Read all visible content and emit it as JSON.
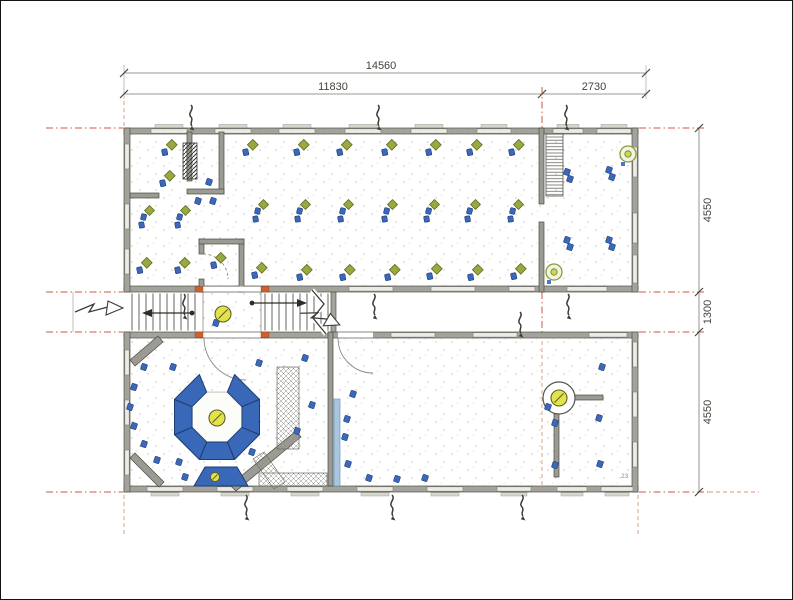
{
  "dimensions": {
    "total_width": "14560",
    "left_width": "11830",
    "right_width": "2730",
    "upper_depth": "4550",
    "corridor_depth": "1300",
    "lower_depth": "4550"
  },
  "annotations": {
    "room_number": "23"
  },
  "colors": {
    "wall_fill": "#a3a39b",
    "wall_edge": "#52524c",
    "window_fill": "#eceae4",
    "axis_red": "#cf5a40",
    "dim_text": "#44423c",
    "furniture_blue": "#3a68bd",
    "octagon_blue": "#3968b8",
    "plant_green": "#9aa93f",
    "lamp_yellow": "#e2e24a",
    "door_orange": "#cf5f2d"
  },
  "plan": {
    "desks_single": [
      [
        168,
        148
      ],
      [
        249,
        148
      ],
      [
        300,
        148
      ],
      [
        343,
        148
      ],
      [
        388,
        148
      ],
      [
        432,
        148
      ],
      [
        473,
        148
      ],
      [
        515,
        148
      ],
      [
        166,
        179
      ],
      [
        217,
        261
      ],
      [
        143,
        266
      ],
      [
        181,
        266
      ],
      [
        258,
        271
      ],
      [
        303,
        273
      ],
      [
        346,
        273
      ],
      [
        391,
        273
      ],
      [
        433,
        272
      ],
      [
        474,
        273
      ],
      [
        517,
        272
      ]
    ],
    "desks_double": [
      [
        145,
        217
      ],
      [
        181,
        217
      ],
      [
        259,
        211
      ],
      [
        301,
        211
      ],
      [
        344,
        211
      ],
      [
        388,
        211
      ],
      [
        430,
        211
      ],
      [
        471,
        211
      ],
      [
        514,
        211
      ]
    ],
    "chairs": [
      [
        143,
        366
      ],
      [
        133,
        386
      ],
      [
        129,
        406
      ],
      [
        133,
        425
      ],
      [
        143,
        443
      ],
      [
        156,
        459
      ],
      [
        172,
        366
      ],
      [
        178,
        461
      ],
      [
        258,
        362
      ],
      [
        304,
        357
      ],
      [
        311,
        404
      ],
      [
        296,
        430
      ],
      [
        251,
        451
      ],
      [
        184,
        476
      ],
      [
        352,
        393
      ],
      [
        346,
        418
      ],
      [
        344,
        436
      ],
      [
        347,
        463
      ],
      [
        368,
        477
      ],
      [
        396,
        478
      ],
      [
        424,
        477
      ],
      [
        601,
        366
      ],
      [
        598,
        417
      ],
      [
        554,
        422
      ],
      [
        554,
        464
      ],
      [
        599,
        463
      ],
      [
        547,
        406
      ],
      [
        208,
        181
      ],
      [
        197,
        200
      ],
      [
        212,
        200
      ],
      [
        215,
        322
      ],
      [
        566,
        171
      ],
      [
        569,
        178
      ],
      [
        608,
        169
      ],
      [
        611,
        176
      ],
      [
        566,
        239
      ],
      [
        569,
        246
      ],
      [
        608,
        239
      ],
      [
        611,
        246
      ]
    ],
    "lamps": [
      [
        222,
        313
      ],
      [
        216,
        417
      ],
      [
        558,
        397
      ]
    ],
    "small_lamps": [
      [
        214,
        476
      ]
    ],
    "ring_lamps": [
      [
        627,
        153
      ],
      [
        553,
        271
      ]
    ],
    "squiggles": [
      [
        190,
        104
      ],
      [
        377,
        104
      ],
      [
        565,
        104
      ],
      [
        183,
        293
      ],
      [
        373,
        293
      ],
      [
        567,
        293
      ],
      [
        519,
        311
      ],
      [
        245,
        494
      ],
      [
        391,
        494
      ],
      [
        521,
        494
      ]
    ],
    "octagon": {
      "cx": 216,
      "cy": 416,
      "outer": 46,
      "inner": 27,
      "skip": 5
    },
    "windows": {
      "top": [
        [
          150,
          36
        ],
        [
          214,
          36
        ],
        [
          278,
          36
        ],
        [
          344,
          36
        ],
        [
          410,
          36
        ],
        [
          476,
          34
        ],
        [
          552,
          30
        ],
        [
          596,
          34
        ]
      ],
      "bottom": [
        [
          146,
          36
        ],
        [
          216,
          36
        ],
        [
          286,
          36
        ],
        [
          356,
          36
        ],
        [
          426,
          36
        ],
        [
          496,
          34
        ],
        [
          556,
          30
        ],
        [
          600,
          32
        ]
      ],
      "upper_inner": [
        [
          348,
          44
        ],
        [
          430,
          44
        ],
        [
          508,
          26
        ],
        [
          566,
          40
        ]
      ],
      "lower_inner": [
        [
          390,
          44
        ],
        [
          472,
          44
        ],
        [
          588,
          38
        ]
      ],
      "left_upper": [
        [
          143,
          25
        ],
        [
          203,
          25
        ],
        [
          248,
          25
        ]
      ],
      "left_lower": [
        [
          349,
          25
        ],
        [
          399,
          25
        ],
        [
          449,
          25
        ]
      ],
      "right_upper": [
        [
          146,
          30
        ],
        [
          212,
          30
        ],
        [
          254,
          28
        ]
      ],
      "right_lower": [
        [
          341,
          25
        ],
        [
          391,
          25
        ],
        [
          441,
          25
        ]
      ]
    }
  }
}
